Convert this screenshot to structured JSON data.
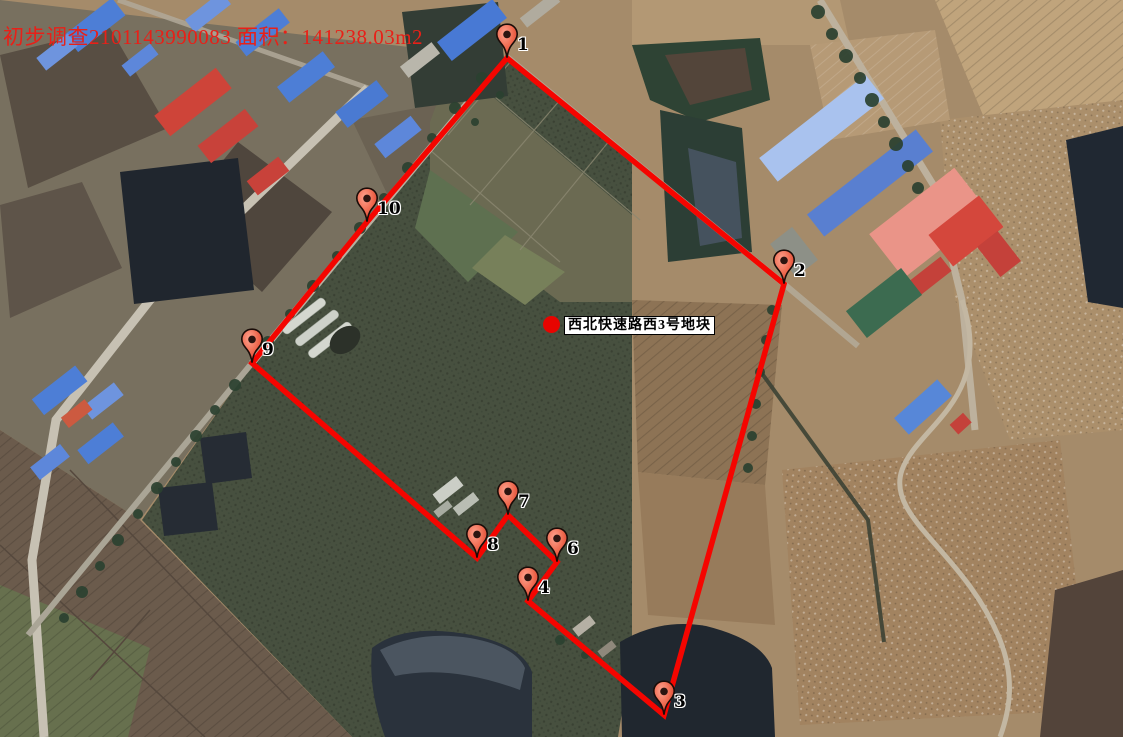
{
  "overlay": {
    "title": "初步调查2101143990083 面积：141238.03m2",
    "title_color": "#e82018",
    "parcel": {
      "label": "西北快速路西3号地块",
      "dot_color": "#e80400",
      "dot_x": 543,
      "dot_y": 316,
      "box_x": 564,
      "box_y": 316
    }
  },
  "boundary": {
    "stroke": "#f50500",
    "stroke_width": 5.5,
    "points": [
      [
        507,
        58
      ],
      [
        784,
        284
      ],
      [
        664,
        715
      ],
      [
        528,
        601
      ],
      [
        557,
        562
      ],
      [
        508,
        515
      ],
      [
        477,
        558
      ],
      [
        252,
        363
      ],
      [
        367,
        222
      ]
    ]
  },
  "markers": [
    {
      "label": "1",
      "x": 507,
      "y": 58
    },
    {
      "label": "2",
      "x": 784,
      "y": 284
    },
    {
      "label": "3",
      "x": 664,
      "y": 715
    },
    {
      "label": "4",
      "x": 528,
      "y": 601
    },
    {
      "label": "6",
      "x": 557,
      "y": 562
    },
    {
      "label": "7",
      "x": 508,
      "y": 515
    },
    {
      "label": "8",
      "x": 477,
      "y": 558
    },
    {
      "label": "9",
      "x": 252,
      "y": 363
    },
    {
      "label": "10",
      "x": 367,
      "y": 222
    }
  ],
  "pin_style": {
    "body": "#ef6a50",
    "body_light": "#fda28e",
    "body_dark": "#d8402c",
    "outline": "#1a0c08",
    "dot": "#2b1410"
  }
}
